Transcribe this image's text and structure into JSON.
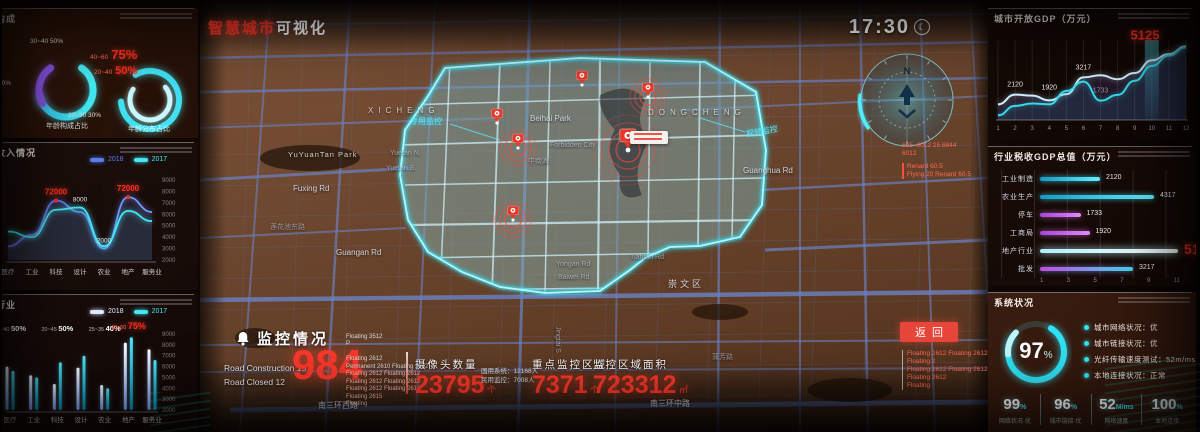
{
  "page": {
    "title_red": "智慧城市",
    "title_white": "可视化",
    "clock": "17:30",
    "clock_icon": "☾",
    "compass_north": "N",
    "back_button": "返回"
  },
  "left_panels": {
    "age": {
      "title": "年龄构成",
      "donut1": {
        "label_top": "30~40 50%",
        "label_bottom": "20~30 30%",
        "label_left": "20%",
        "caption": "年龄构成占比"
      },
      "donut2": {
        "labels": [
          {
            "range": "40~60",
            "pct": "75%"
          },
          {
            "range": "20~40",
            "pct": "50%"
          }
        ],
        "caption": "年龄分布占比"
      }
    },
    "income": {
      "title": "行业收入情况",
      "legend": [
        {
          "label": "2018",
          "color": "#5a7df2"
        },
        {
          "label": "2017",
          "color": "#45e6f2"
        }
      ]
    },
    "industry": {
      "title": "收入行业",
      "legend": [
        {
          "label": "2018",
          "color": "#dfe9ff"
        },
        {
          "label": "2017",
          "color": "#45e6f2"
        }
      ]
    }
  },
  "right_panels": {
    "gdp": {
      "title": "城市开放GDP（万元）"
    },
    "tax": {
      "title": "行业税收GDP总值（万元）",
      "xticks": [
        "1",
        "3",
        "5",
        "7",
        "9",
        "11"
      ]
    },
    "system": {
      "title": "系统状况",
      "gauge_value": "97",
      "gauge_unit": "%",
      "items": [
        {
          "label": "城市网络状况",
          "value": "优"
        },
        {
          "label": "城市链接状况",
          "value": "优"
        },
        {
          "label": "光纤传输速度测试",
          "value": "52m/ms"
        },
        {
          "label": "本地连接状况",
          "value": "正常"
        }
      ],
      "stats": [
        {
          "value": "99",
          "unit": "%",
          "caption": "网络状况·优"
        },
        {
          "value": "96",
          "unit": "%",
          "caption": "城市链接·优"
        },
        {
          "value": "52",
          "unit": "M/ms",
          "caption": "网络速度"
        },
        {
          "value": "100",
          "unit": "%",
          "caption": "本地连接"
        }
      ]
    }
  },
  "monitor": {
    "title": "监控情况",
    "road_lines": [
      "Road Construction  15",
      "Road Closed  12"
    ],
    "big_number": "984",
    "float_header": [
      "Floating 3512",
      "P"
    ],
    "float_lines": [
      "Floating 2612",
      "Permanent 2610 Floating 2612",
      "Floating 2612 Floating 2612",
      "Floating 2612 Floating 2612",
      "Floating 2612 Floating 2612",
      "Floating 2615",
      "Floating"
    ],
    "stats": [
      {
        "label": "摄像头数量",
        "value": "23795",
        "unit": "个"
      },
      {
        "label": "重点监控区域",
        "value": "7371",
        "unit": "个"
      },
      {
        "label": "监控区域面积",
        "value": "723312",
        "unit": "㎡"
      }
    ],
    "side_notes": [
      "国用系统：12168人",
      "民用监控：7008人"
    ]
  },
  "annotations": {
    "compass_notes": [
      "605~6012 25.6844",
      "6012"
    ],
    "compass_box": [
      "Renard 60.5",
      "Flying 20 Renard 60.5"
    ],
    "below_back": [
      "Floating 2612 Floating 2612",
      "Floating 2",
      "Floating 2612 Floating 2612",
      "Floating 2612",
      "Floating"
    ]
  },
  "map_labels": [
    {
      "t": "XICHENG",
      "x": 168,
      "y": 106,
      "c": "area"
    },
    {
      "t": "DONGCHENG",
      "x": 448,
      "y": 108,
      "c": "area"
    },
    {
      "t": "Beihai Park",
      "x": 330,
      "y": 114,
      "c": "road"
    },
    {
      "t": "Forbidden City",
      "x": 350,
      "y": 142,
      "c": "dim"
    },
    {
      "t": "中南海",
      "x": 328,
      "y": 156,
      "c": "dim"
    },
    {
      "t": "YuYuanTan Park",
      "x": 88,
      "y": 150,
      "c": "park"
    },
    {
      "t": "Fuxing Rd",
      "x": 93,
      "y": 184,
      "c": "road"
    },
    {
      "t": "Yuetan N.",
      "x": 190,
      "y": 150,
      "c": "dim"
    },
    {
      "t": "Yuetan S.",
      "x": 186,
      "y": 165,
      "c": "dim"
    },
    {
      "t": "莲花池东路",
      "x": 70,
      "y": 222,
      "c": "dim"
    },
    {
      "t": "Guangan Rd",
      "x": 136,
      "y": 248,
      "c": "road"
    },
    {
      "t": "Guanghua Rd",
      "x": 543,
      "y": 166,
      "c": "road"
    },
    {
      "t": "Yongan Rd",
      "x": 356,
      "y": 261,
      "c": "dim"
    },
    {
      "t": "Baiwei Rd",
      "x": 358,
      "y": 274,
      "c": "dim"
    },
    {
      "t": "Tiantan Rd",
      "x": 430,
      "y": 254,
      "c": "dim"
    },
    {
      "t": "崇文区",
      "x": 468,
      "y": 277,
      "c": "areaSm"
    },
    {
      "t": "蒲芳路",
      "x": 512,
      "y": 352,
      "c": "dim"
    },
    {
      "t": "Jingtai S",
      "x": 344,
      "y": 336,
      "c": "dim",
      "rot": 90
    },
    {
      "t": "南三环西路",
      "x": 118,
      "y": 400,
      "c": "road"
    },
    {
      "t": "南三环中路",
      "x": 450,
      "y": 398,
      "c": "road"
    },
    {
      "t": "专用监控",
      "x": 210,
      "y": 116,
      "c": "cyan"
    },
    {
      "t": "视频监控",
      "x": 546,
      "y": 126,
      "c": "cyan",
      "rot": -10
    }
  ],
  "chart_data": [
    {
      "id": "income_line",
      "type": "line",
      "title": "行业收入情况",
      "categories": [
        "医疗",
        "工业",
        "科技",
        "设计",
        "农业",
        "地产",
        "服务业"
      ],
      "series": [
        {
          "name": "2018",
          "color": "#5a7df2",
          "values": [
            3200,
            4200,
            7200,
            6200,
            3000,
            7500,
            6200
          ]
        },
        {
          "name": "2017",
          "color": "#45e6f2",
          "values": [
            4500,
            4000,
            6400,
            6600,
            3200,
            6300,
            5400
          ]
        }
      ],
      "ylim": [
        2000,
        9000
      ],
      "yticks": [
        9000,
        8000,
        7000,
        6000,
        5000,
        4000,
        3000,
        2000
      ],
      "point_labels": [
        {
          "i": 2,
          "s": 0,
          "text": "72000",
          "red": true
        },
        {
          "i": 5,
          "s": 0,
          "text": "72000",
          "red": true
        },
        {
          "i": 3,
          "s": 1,
          "text": "8000",
          "red": false
        },
        {
          "i": 4,
          "s": 0,
          "text": "2000",
          "red": false
        }
      ]
    },
    {
      "id": "industry_bar",
      "type": "bar",
      "title": "收入行业",
      "categories": [
        "医疗",
        "工业",
        "科技",
        "设计",
        "农业",
        "地产",
        "服务业"
      ],
      "series": [
        {
          "name": "2018",
          "values": [
            6000,
            5200,
            4400,
            5900,
            4300,
            8200,
            7600
          ]
        },
        {
          "name": "2017",
          "values": [
            5600,
            5000,
            6400,
            7000,
            4000,
            8700,
            6600
          ]
        }
      ],
      "ylim": [
        2000,
        9000
      ],
      "yticks": [
        9000,
        8000,
        7000,
        6000,
        5000,
        4000,
        3000,
        2000
      ],
      "annotations": [
        {
          "i": 0,
          "text": "30~40 50%",
          "red": false
        },
        {
          "i": 2,
          "text": "20~45 50%",
          "red": false
        },
        {
          "i": 4,
          "text": "25~35 40%",
          "red": false
        },
        {
          "i": 5,
          "text": "40~60 75%",
          "red": true
        }
      ]
    },
    {
      "id": "gdp_line",
      "type": "line",
      "title": "城市开放GDP（万元）",
      "x": [
        1,
        2,
        3,
        4,
        5,
        6,
        7,
        8,
        9,
        10,
        11,
        12
      ],
      "series": [
        {
          "name": "line-a",
          "color": "#cfeeff",
          "values": [
            1500,
            2120,
            2050,
            1750,
            2150,
            3217,
            3350,
            3100,
            3500,
            4300,
            4700,
            5200
          ]
        },
        {
          "name": "line-b",
          "color": "#38d8ec",
          "values": [
            800,
            1400,
            1550,
            1500,
            2350,
            2950,
            1733,
            2100,
            3000,
            3950,
            4600,
            5125
          ]
        }
      ],
      "ylim": [
        500,
        5600
      ],
      "highlight_x": 10,
      "point_labels": [
        {
          "x": 2,
          "y": 2120,
          "text": "2120"
        },
        {
          "x": 4,
          "y": 1920,
          "text": "1920"
        },
        {
          "x": 6,
          "y": 3217,
          "text": "3217"
        },
        {
          "x": 7,
          "y": 1733,
          "text": "1733",
          "dim": true
        },
        {
          "x": 9.6,
          "y": 5125,
          "text": "5125",
          "red": true
        }
      ]
    },
    {
      "id": "tax_hbar",
      "type": "bar",
      "orientation": "horizontal",
      "title": "行业税收GDP总值（万元）",
      "rows": [
        {
          "label": "工业制造",
          "value": "2120",
          "pct": 40,
          "color": "cyan",
          "red": false
        },
        {
          "label": "农业生产",
          "value": "4317",
          "pct": 76,
          "color": "cyan",
          "red": false
        },
        {
          "label": "停车",
          "value": "1733",
          "pct": 27,
          "color": "magenta",
          "red": false
        },
        {
          "label": "工商局",
          "value": "1920",
          "pct": 33,
          "color": "magenta",
          "red": false
        },
        {
          "label": "地产行业",
          "value": "5134",
          "pct": 92,
          "color": "white",
          "red": true
        },
        {
          "label": "批发",
          "value": "3217",
          "pct": 62,
          "color": "mix",
          "red": false
        }
      ]
    },
    {
      "id": "age_donut1",
      "type": "pie",
      "slices": [
        {
          "label": "30~40",
          "pct": 50
        },
        {
          "label": "20~30",
          "pct": 30
        },
        {
          "label": "other",
          "pct": 20
        }
      ]
    },
    {
      "id": "age_donut2",
      "type": "pie",
      "slices": [
        {
          "label": "40~60",
          "pct": 75
        },
        {
          "label": "20~40",
          "pct": 50
        }
      ]
    }
  ]
}
